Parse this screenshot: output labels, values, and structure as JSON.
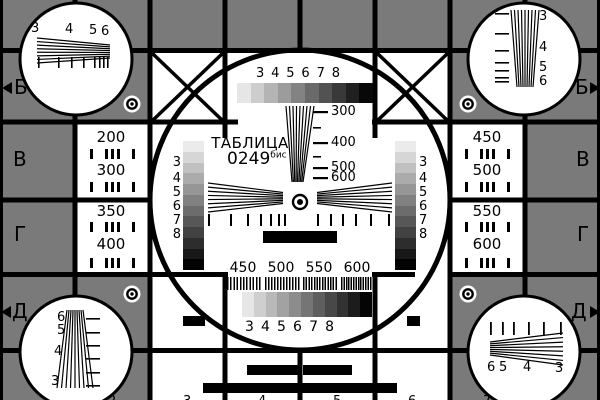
{
  "colors": {
    "background_gray": "#7a7a7a",
    "ink_black": "#000000",
    "panel_white": "#ffffff"
  },
  "title": {
    "name": "ТАБЛИЦА",
    "number": "0249",
    "suffix": "бис"
  },
  "center": {
    "top_scale_labels": [
      "3",
      "4",
      "5",
      "6",
      "7",
      "8"
    ],
    "wedge_frequency_labels": [
      "300",
      "400",
      "500",
      "600"
    ],
    "left_scale_labels": [
      "3",
      "4",
      "5",
      "6",
      "7",
      "8"
    ],
    "right_scale_labels": [
      "3",
      "4",
      "5",
      "6",
      "7",
      "8"
    ],
    "bottom_frequency_labels": [
      "450",
      "500",
      "550",
      "600"
    ],
    "bottom_scale_labels": [
      "3",
      "4",
      "5",
      "6",
      "7",
      "8"
    ]
  },
  "side_cells": {
    "left_top": [
      "200",
      "300"
    ],
    "left_bottom": [
      "350",
      "400"
    ],
    "right_top": [
      "450",
      "500"
    ],
    "right_bottom": [
      "550",
      "600"
    ]
  },
  "row_letters": {
    "left": [
      "Б",
      "В",
      "Г",
      "Д"
    ],
    "right": [
      "Б",
      "В",
      "Г",
      "Д"
    ]
  },
  "corner_labels": {
    "top_left": [
      "3",
      "4",
      "5",
      "6"
    ],
    "top_right": [
      "3",
      "4",
      "5",
      "6"
    ],
    "bottom_left": [
      "6",
      "5",
      "4",
      "3"
    ],
    "bottom_right": [
      "6",
      "5",
      "4",
      "3"
    ]
  },
  "edge_digits": {
    "top": [
      "3",
      "4",
      "5",
      "6"
    ],
    "bottom": [
      "2",
      "3",
      "4",
      "5",
      "6",
      "7"
    ]
  }
}
